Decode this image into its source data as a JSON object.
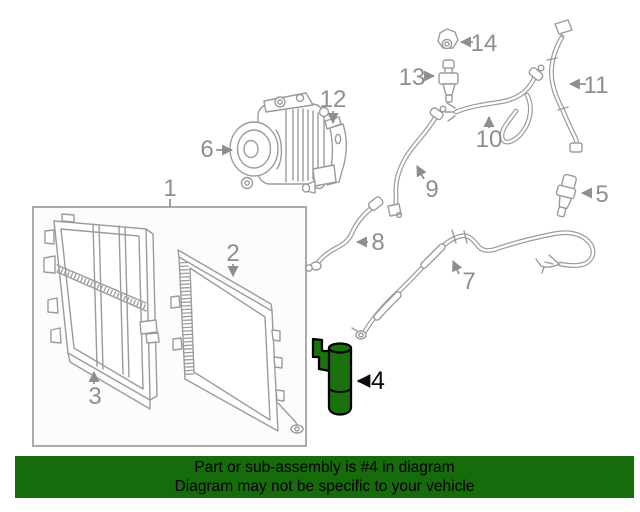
{
  "diagram": {
    "highlighted_part_number": "4",
    "callouts": [
      {
        "label": "1"
      },
      {
        "label": "2"
      },
      {
        "label": "3"
      },
      {
        "label": "4"
      },
      {
        "label": "5"
      },
      {
        "label": "6"
      },
      {
        "label": "7"
      },
      {
        "label": "8"
      },
      {
        "label": "9"
      },
      {
        "label": "10"
      },
      {
        "label": "11"
      },
      {
        "label": "12"
      },
      {
        "label": "13"
      },
      {
        "label": "14"
      }
    ],
    "colors": {
      "artwork_line": "#9b9b9b",
      "callout_label": "#8e8e8e",
      "highlight_fill": "#1c710f",
      "highlight_outline": "#000000",
      "banner_background": "#166b0a",
      "banner_text": "#000000"
    }
  },
  "banner": {
    "line1": "Part or sub-assembly is #4 in diagram",
    "line2": "Diagram may not be specific to your vehicle"
  }
}
